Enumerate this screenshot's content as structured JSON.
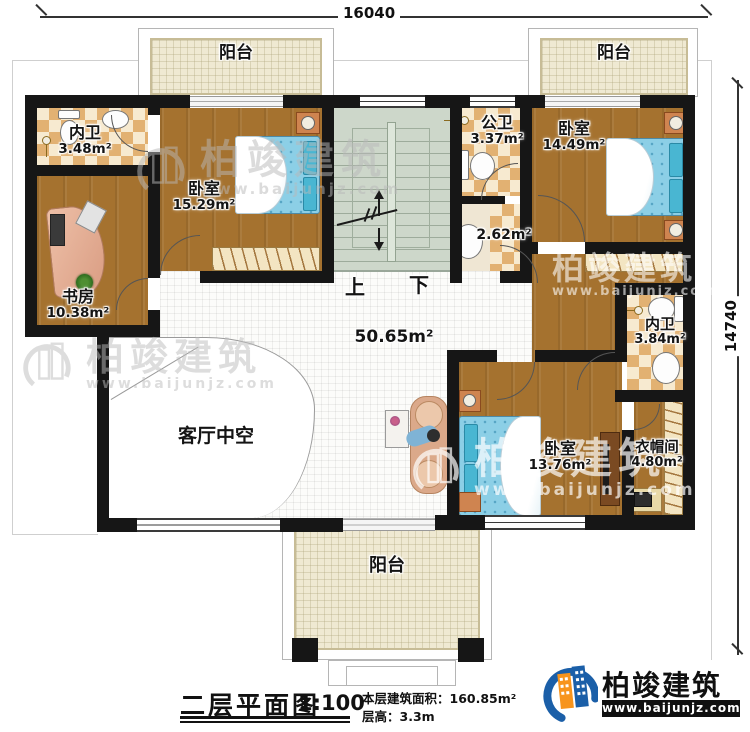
{
  "dimensions": {
    "top": "16040",
    "right": "14740"
  },
  "stairs": {
    "up": "上",
    "down": "下"
  },
  "rooms": {
    "balcony_top_left": {
      "name": "阳台"
    },
    "balcony_top_right": {
      "name": "阳台"
    },
    "balcony_bottom": {
      "name": "阳台"
    },
    "ensuite_top_left": {
      "name": "内卫",
      "area": "3.48m²"
    },
    "study": {
      "name": "书房",
      "area": "10.38m²"
    },
    "bedroom_top_left": {
      "name": "卧室",
      "area": "15.29m²"
    },
    "public_bath": {
      "name": "公卫",
      "area": "3.37m²"
    },
    "shower_room": {
      "area": "2.62m²"
    },
    "bedroom_top_right": {
      "name": "卧室",
      "area": "14.49m²"
    },
    "ensuite_right": {
      "name": "内卫",
      "area": "3.84m²"
    },
    "hall": {
      "area": "50.65m²"
    },
    "living_void": {
      "name": "客厅中空"
    },
    "bedroom_bottom": {
      "name": "卧室",
      "area": "13.76m²"
    },
    "cloakroom": {
      "name": "衣帽间",
      "area": "4.80m²"
    }
  },
  "titleblock": {
    "title": "二层平面图",
    "scale": "1:100",
    "area_text": "本层建筑面积：160.85m²",
    "height_text": "层高：3.3m"
  },
  "logo": {
    "company": "柏竣建筑",
    "website": "www.baijunjz.com"
  },
  "watermark": {
    "company": "柏竣建筑",
    "website": "www.baijunjz.com"
  },
  "colors": {
    "wall": "#161616",
    "wood": "#a5722f",
    "tile_dark": "#e2b172",
    "tile_light": "#f7ead0",
    "balcony": "#efe9d2",
    "stairs": "#cdd7ca",
    "bed": "#8ccfe6",
    "logo_blue": "#1b5fa8",
    "logo_orange": "#f7941d"
  }
}
